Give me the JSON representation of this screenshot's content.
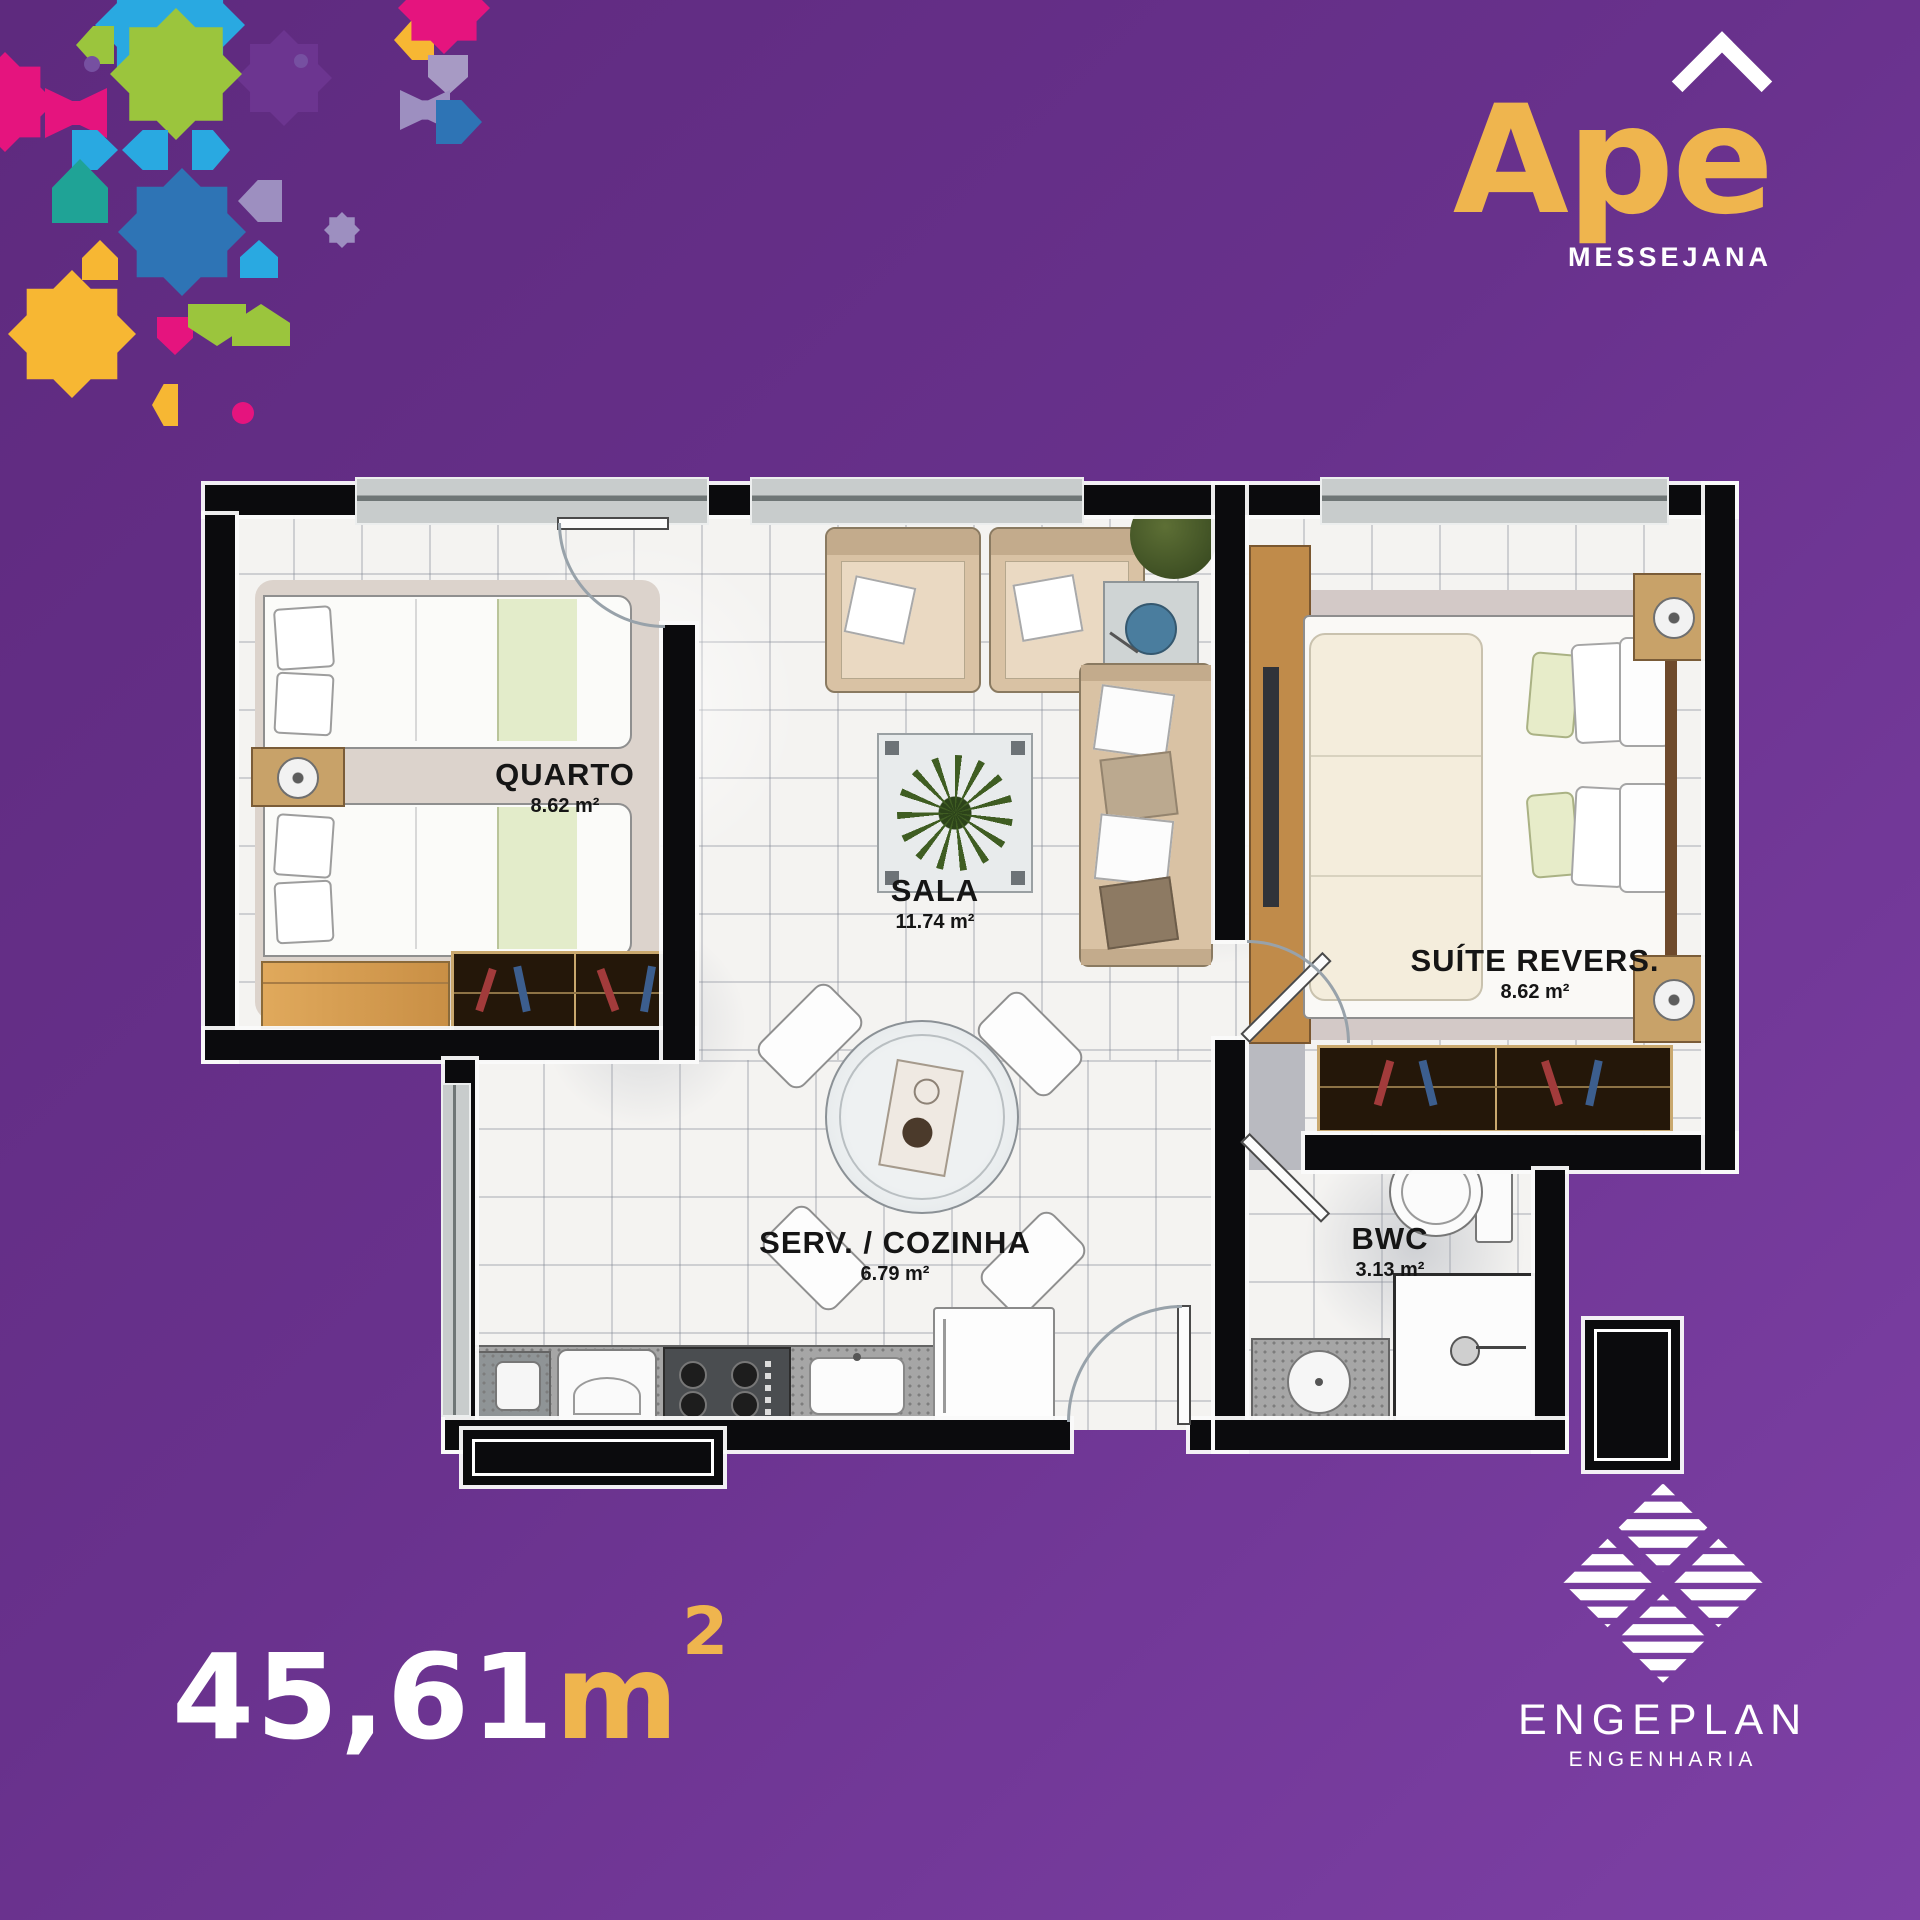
{
  "brand": {
    "base": "Ap",
    "accented_letter": "e",
    "display_name": "Apê",
    "tagline": "MESSEJANA",
    "gold": "#EFB54E",
    "white": "#FFFFFF"
  },
  "plan": {
    "rooms": [
      {
        "id": "quarto",
        "label": "QUARTO",
        "area": "8.62 m²"
      },
      {
        "id": "sala",
        "label": "SALA",
        "area": "11.74 m²"
      },
      {
        "id": "suite",
        "label": "SUÍTE REVERS.",
        "area": "8.62 m²"
      },
      {
        "id": "serv_cozinha",
        "label": "SERV. / COZINHA",
        "area": "6.79 m²"
      },
      {
        "id": "bwc",
        "label": "BWC",
        "area": "3.13 m²"
      }
    ]
  },
  "total_area": {
    "value": "45,61",
    "unit": "m",
    "exponent": "2"
  },
  "builder": {
    "name": "ENGEPLAN",
    "subtitle": "ENGENHARIA"
  },
  "palette": {
    "background": "#68318C",
    "gold": "#EFB54E",
    "wall": "#0B0B0D",
    "floor": "#F4F3F1",
    "mosaic": [
      "#29A9E1",
      "#2E74B5",
      "#9BC53D",
      "#E5147E",
      "#F7B733",
      "#1FA396",
      "#9D8FC0",
      "#7650A1"
    ]
  }
}
